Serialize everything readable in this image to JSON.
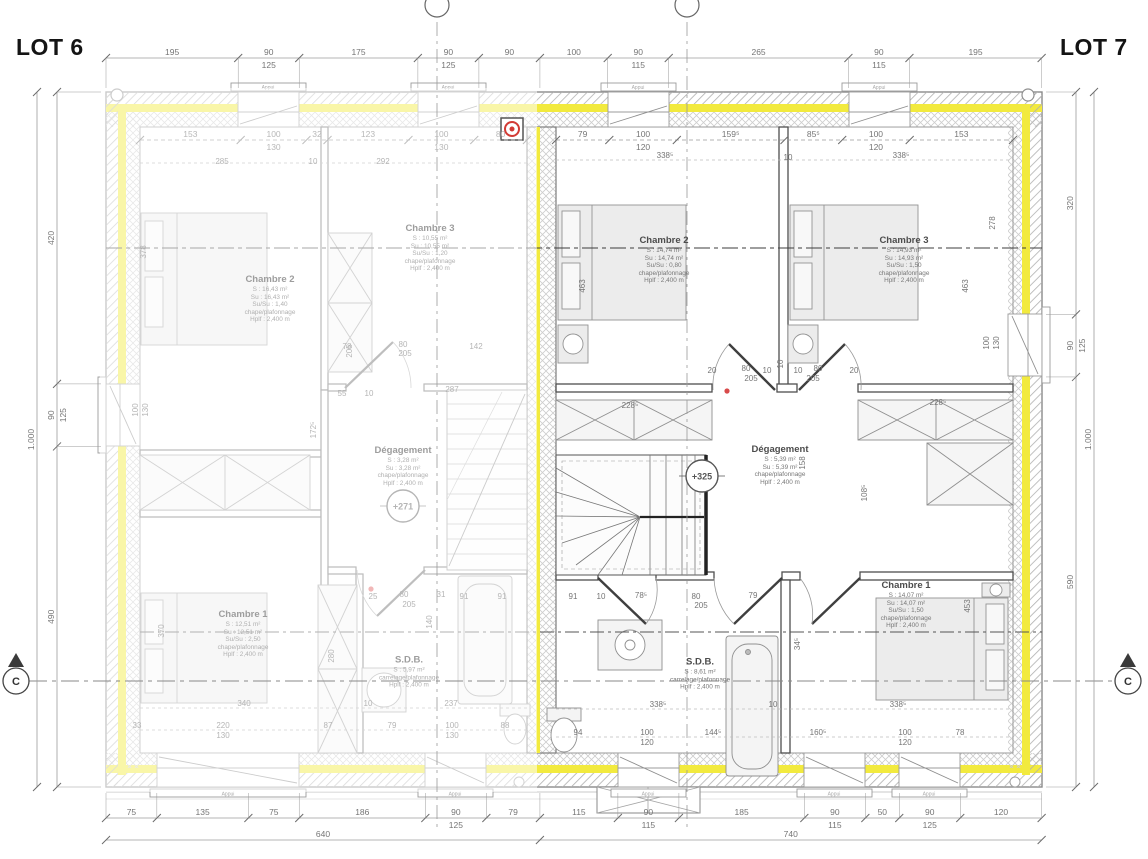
{
  "titles": {
    "lot6": "LOT 6",
    "lot7": "LOT 7"
  },
  "markers": {
    "section_letter": "C",
    "window_sill_label": "Appui",
    "levels": [
      {
        "t": "+271",
        "x": 403,
        "y": 506,
        "faded": true
      },
      {
        "t": "+325",
        "x": 702,
        "y": 476,
        "faded": false
      }
    ]
  },
  "rooms": [
    {
      "lot": "6",
      "name": "Chambre 2",
      "x": 270,
      "y": 300,
      "lines": [
        "S : 16,43 m²",
        "Su : 16,43 m²",
        "Su/Su : 1,40",
        "chape/plafonnage",
        "Hplf : 2,400 m"
      ]
    },
    {
      "lot": "6",
      "name": "Chambre 3",
      "x": 430,
      "y": 249,
      "lines": [
        "S : 10,55 m²",
        "Su : 10,55 m²",
        "Su/Su : 1,20",
        "chape/plafonnage",
        "Hplf : 2,400 m"
      ]
    },
    {
      "lot": "6",
      "name": "Dégagement",
      "x": 403,
      "y": 467,
      "lines": [
        "S : 3,28 m²",
        "Su : 3,28 m²",
        "chape/plafonnage",
        "Hplf : 2,400 m"
      ]
    },
    {
      "lot": "6",
      "name": "Chambre 1",
      "x": 243,
      "y": 635,
      "lines": [
        "S : 12,51 m²",
        "Su : 12,51 m²",
        "Su/Su : 2,50",
        "chape/plafonnage",
        "Hplf : 2,400 m"
      ]
    },
    {
      "lot": "6",
      "name": "S.D.B.",
      "x": 409,
      "y": 673,
      "lines": [
        "S : 5,97 m²",
        "carrelage/plafonnage",
        "Hplf : 2,400 m"
      ]
    },
    {
      "lot": "7",
      "name": "Chambre 2",
      "x": 664,
      "y": 261,
      "lines": [
        "S : 14,74 m²",
        "Su : 14,74 m²",
        "Su/Su : 0,80",
        "chape/plafonnage",
        "Hplf : 2,400 m"
      ]
    },
    {
      "lot": "7",
      "name": "Chambre 3",
      "x": 904,
      "y": 261,
      "lines": [
        "S : 14,93 m²",
        "Su : 14,93 m²",
        "Su/Su : 1,50",
        "chape/plafonnage",
        "Hplf : 2,400 m"
      ]
    },
    {
      "lot": "7",
      "name": "Dégagement",
      "x": 780,
      "y": 466,
      "lines": [
        "S : 5,39 m²",
        "Su : 5,39 m²",
        "chape/plafonnage",
        "Hplf : 2,400 m"
      ]
    },
    {
      "lot": "7",
      "name": "S.D.B.",
      "x": 700,
      "y": 675,
      "lines": [
        "S : 8,61 m²",
        "carrelage/plafonnage",
        "Hplf : 2,400 m"
      ]
    },
    {
      "lot": "7",
      "name": "Chambre 1",
      "x": 906,
      "y": 606,
      "lines": [
        "S : 14,07 m²",
        "Su : 14,07 m²",
        "Su/Su : 1,50",
        "chape/plafonnage",
        "Hplf : 2,400 m"
      ]
    }
  ],
  "dim_chains": [
    {
      "id": "top-outer",
      "dir": "h",
      "start": 106,
      "pos": 58,
      "k": 0.678,
      "ext": 88,
      "entries": [
        {
          "v": "195"
        },
        {
          "v": "90",
          "v2": "125"
        },
        {
          "v": "175"
        },
        {
          "v": "90",
          "v2": "125"
        },
        {
          "v": "90"
        },
        {
          "v": "100"
        },
        {
          "v": "90",
          "v2": "115"
        },
        {
          "v": "265"
        },
        {
          "v": "90",
          "v2": "115"
        },
        {
          "v": "195"
        }
      ]
    },
    {
      "id": "top-inner-lot6",
      "dir": "h",
      "start": 140,
      "pos": 140,
      "k": 0.658,
      "dashed": true,
      "faded": true,
      "entries": [
        {
          "v": "153"
        },
        {
          "v": "100",
          "v2": "130"
        },
        {
          "v": "32"
        },
        {
          "v": "123"
        },
        {
          "v": "100",
          "v2": "130"
        },
        {
          "v": "80"
        }
      ]
    },
    {
      "id": "top-inner-lot7",
      "dir": "h",
      "start": 556,
      "pos": 140,
      "k": 0.675,
      "dashed": true,
      "entries": [
        {
          "v": "79"
        },
        {
          "v": "100",
          "v2": "120"
        },
        {
          "v": "159⁵"
        },
        {
          "v": "85⁵"
        },
        {
          "v": "100",
          "v2": "120"
        },
        {
          "v": "153"
        }
      ]
    },
    {
      "id": "bottom-outer",
      "dir": "h",
      "start": 106,
      "pos": 818,
      "k": 0.678,
      "ext": 793,
      "entries": [
        {
          "v": "75"
        },
        {
          "v": "135"
        },
        {
          "v": "75"
        },
        {
          "v": "186"
        },
        {
          "v": "90",
          "v2": "125"
        },
        {
          "v": "79"
        },
        {
          "v": "115"
        },
        {
          "v": "90",
          "v2": "115"
        },
        {
          "v": "185"
        },
        {
          "v": "90",
          "v2": "115"
        },
        {
          "v": "50"
        },
        {
          "v": "90",
          "v2": "125"
        },
        {
          "v": "120"
        }
      ]
    },
    {
      "id": "bottom-total",
      "dir": "h",
      "start": 106,
      "pos": 840,
      "k": 0.678,
      "entries": [
        {
          "v": "640"
        },
        {
          "v": "740"
        }
      ]
    },
    {
      "id": "left-outer",
      "dir": "v",
      "start": 92,
      "pos": 57,
      "k": 0.695,
      "ext": 101,
      "entries": [
        {
          "v": "420"
        },
        {
          "v": "90",
          "v2": "125"
        },
        {
          "v": "490"
        }
      ]
    },
    {
      "id": "left-total",
      "dir": "v",
      "start": 92,
      "pos": 37,
      "k": 0.695,
      "entries": [
        {
          "v": "1.000"
        }
      ]
    },
    {
      "id": "right-outer",
      "dir": "v",
      "start": 92,
      "pos": 1076,
      "k": 0.695,
      "ext": 1046,
      "entries": [
        {
          "v": "320"
        },
        {
          "v": "90",
          "v2": "125"
        },
        {
          "v": "590"
        }
      ]
    },
    {
      "id": "right-total",
      "dir": "v",
      "start": 92,
      "pos": 1094,
      "k": 0.695,
      "entries": [
        {
          "v": "1.000"
        }
      ]
    }
  ],
  "float_dims": [
    {
      "t": "285",
      "x": 222,
      "y": 164,
      "f": 1
    },
    {
      "t": "10",
      "x": 313,
      "y": 164,
      "f": 1
    },
    {
      "t": "292",
      "x": 383,
      "y": 164,
      "f": 1
    },
    {
      "t": "338⁵",
      "x": 665,
      "y": 158
    },
    {
      "t": "10",
      "x": 788,
      "y": 160
    },
    {
      "t": "338⁵",
      "x": 901,
      "y": 158
    },
    {
      "t": "378",
      "x": 146,
      "y": 252,
      "r": 1,
      "f": 1
    },
    {
      "t": "100",
      "x": 138,
      "y": 410,
      "r": 1,
      "f": 1
    },
    {
      "t": "130",
      "x": 148,
      "y": 410,
      "r": 1,
      "f": 1
    },
    {
      "t": "370",
      "x": 164,
      "y": 631,
      "r": 1,
      "f": 1
    },
    {
      "t": "463",
      "x": 585,
      "y": 286,
      "r": 1
    },
    {
      "t": "463",
      "x": 968,
      "y": 286,
      "r": 1
    },
    {
      "t": "278",
      "x": 995,
      "y": 223,
      "r": 1
    },
    {
      "t": "100",
      "x": 989,
      "y": 343,
      "r": 1
    },
    {
      "t": "130",
      "x": 999,
      "y": 343,
      "r": 1
    },
    {
      "t": "205",
      "x": 352,
      "y": 351,
      "r": 1,
      "f": 1
    },
    {
      "t": "78",
      "x": 347,
      "y": 349,
      "f": 1
    },
    {
      "t": "80",
      "x": 403,
      "y": 347,
      "f": 1
    },
    {
      "t": "205",
      "x": 405,
      "y": 356,
      "f": 1
    },
    {
      "t": "142",
      "x": 476,
      "y": 349,
      "f": 1
    },
    {
      "t": "172⁵",
      "x": 316,
      "y": 430,
      "r": 1,
      "f": 1
    },
    {
      "t": "55",
      "x": 342,
      "y": 396,
      "f": 1
    },
    {
      "t": "10",
      "x": 369,
      "y": 396,
      "f": 1
    },
    {
      "t": "287",
      "x": 452,
      "y": 392,
      "f": 1
    },
    {
      "t": "228⁵",
      "x": 630,
      "y": 408
    },
    {
      "t": "228⁵",
      "x": 938,
      "y": 405
    },
    {
      "t": "20",
      "x": 712,
      "y": 373
    },
    {
      "t": "80",
      "x": 746,
      "y": 371
    },
    {
      "t": "205",
      "x": 751,
      "y": 381
    },
    {
      "t": "10",
      "x": 767,
      "y": 373
    },
    {
      "t": "10",
      "x": 783,
      "y": 364,
      "r": 1
    },
    {
      "t": "10",
      "x": 798,
      "y": 373
    },
    {
      "t": "80",
      "x": 818,
      "y": 371
    },
    {
      "t": "205",
      "x": 813,
      "y": 381
    },
    {
      "t": "20",
      "x": 854,
      "y": 373
    },
    {
      "t": "158",
      "x": 805,
      "y": 463,
      "r": 1
    },
    {
      "t": "108⁵",
      "x": 867,
      "y": 493,
      "r": 1
    },
    {
      "t": "25",
      "x": 373,
      "y": 599,
      "f": 1
    },
    {
      "t": "80",
      "x": 404,
      "y": 597,
      "f": 1
    },
    {
      "t": "205",
      "x": 409,
      "y": 607,
      "f": 1
    },
    {
      "t": "31",
      "x": 441,
      "y": 597,
      "f": 1
    },
    {
      "t": "91",
      "x": 464,
      "y": 599,
      "f": 1
    },
    {
      "t": "91",
      "x": 502,
      "y": 599,
      "f": 1
    },
    {
      "t": "91",
      "x": 573,
      "y": 599
    },
    {
      "t": "10",
      "x": 601,
      "y": 599
    },
    {
      "t": "78⁵",
      "x": 641,
      "y": 598
    },
    {
      "t": "80",
      "x": 696,
      "y": 599
    },
    {
      "t": "205",
      "x": 701,
      "y": 608
    },
    {
      "t": "79",
      "x": 753,
      "y": 598
    },
    {
      "t": "140",
      "x": 432,
      "y": 622,
      "r": 1,
      "f": 1
    },
    {
      "t": "280",
      "x": 334,
      "y": 656,
      "r": 1,
      "f": 1
    },
    {
      "t": "34⁵",
      "x": 800,
      "y": 644,
      "r": 1
    },
    {
      "t": "453",
      "x": 970,
      "y": 606,
      "r": 1
    },
    {
      "t": "340",
      "x": 244,
      "y": 706,
      "f": 1
    },
    {
      "t": "10",
      "x": 368,
      "y": 706,
      "f": 1
    },
    {
      "t": "237",
      "x": 451,
      "y": 706,
      "f": 1
    },
    {
      "t": "338⁵",
      "x": 658,
      "y": 707
    },
    {
      "t": "10",
      "x": 773,
      "y": 707
    },
    {
      "t": "338⁵",
      "x": 898,
      "y": 707
    },
    {
      "t": "33",
      "x": 137,
      "y": 728,
      "f": 1
    },
    {
      "t": "220",
      "x": 223,
      "y": 728,
      "f": 1
    },
    {
      "t": "130",
      "x": 223,
      "y": 738,
      "f": 1
    },
    {
      "t": "87",
      "x": 328,
      "y": 728,
      "f": 1
    },
    {
      "t": "79",
      "x": 392,
      "y": 728,
      "f": 1
    },
    {
      "t": "100",
      "x": 452,
      "y": 728,
      "f": 1
    },
    {
      "t": "130",
      "x": 452,
      "y": 738,
      "f": 1
    },
    {
      "t": "88",
      "x": 505,
      "y": 728,
      "f": 1
    },
    {
      "t": "94",
      "x": 578,
      "y": 735
    },
    {
      "t": "100",
      "x": 647,
      "y": 735
    },
    {
      "t": "120",
      "x": 647,
      "y": 745
    },
    {
      "t": "144⁵",
      "x": 713,
      "y": 735
    },
    {
      "t": "160⁵",
      "x": 818,
      "y": 735
    },
    {
      "t": "100",
      "x": 905,
      "y": 735
    },
    {
      "t": "120",
      "x": 905,
      "y": 745
    },
    {
      "t": "78",
      "x": 960,
      "y": 735
    }
  ]
}
